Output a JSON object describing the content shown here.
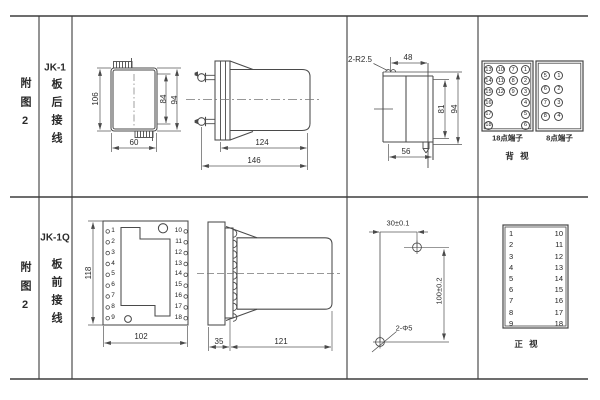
{
  "colors": {
    "ink": "#4a4a4a",
    "text": "#2c2c2c"
  },
  "rows": [
    {
      "figure": "附图2",
      "model": "JK-1",
      "wiring": "板后接线"
    },
    {
      "figure": "附图2",
      "model": "JK-1Q",
      "wiring": "板前接线"
    }
  ],
  "jk1_front": {
    "height": "106",
    "inner_height": "84",
    "outer_height": "94",
    "width": "60"
  },
  "jk1_side": {
    "case_depth": "124",
    "total_depth": "146"
  },
  "jk1_top": {
    "tab_radius": "2-R2.5",
    "top_width": "48",
    "inner_height": "81",
    "outer_height": "94",
    "bottom_width": "56"
  },
  "rear_view": {
    "block18_label": "18点端子",
    "block18_cells": [
      "13",
      "10",
      "7",
      "1",
      "14",
      "11",
      "8",
      "2",
      "15",
      "12",
      "9",
      "3",
      "16",
      "",
      "",
      "4",
      "17",
      "",
      "",
      "5",
      "18",
      "",
      "",
      "6"
    ],
    "block8_label": "8点端子",
    "block8_cells": [
      "5",
      "1",
      "6",
      "2",
      "7",
      "3",
      "8",
      "4"
    ],
    "caption": "背 视"
  },
  "jk1q_front": {
    "height": "118",
    "width": "102",
    "left_terminals": [
      "1",
      "2",
      "3",
      "4",
      "5",
      "6",
      "7",
      "8",
      "9"
    ],
    "right_terminals": [
      "10",
      "11",
      "12",
      "13",
      "14",
      "15",
      "16",
      "17",
      "18"
    ]
  },
  "jk1q_side": {
    "panel_depth": "35",
    "case_depth": "121"
  },
  "drill_plan": {
    "hole_spacing_x": "30±0.1",
    "hole_spacing_y": "100±0.2",
    "holes": "2-Φ5"
  },
  "front_view": {
    "left_terminals": [
      "1",
      "2",
      "3",
      "4",
      "5",
      "6",
      "7",
      "8",
      "9"
    ],
    "right_terminals": [
      "10",
      "11",
      "12",
      "13",
      "14",
      "15",
      "16",
      "17",
      "18"
    ],
    "caption": "正 视"
  }
}
